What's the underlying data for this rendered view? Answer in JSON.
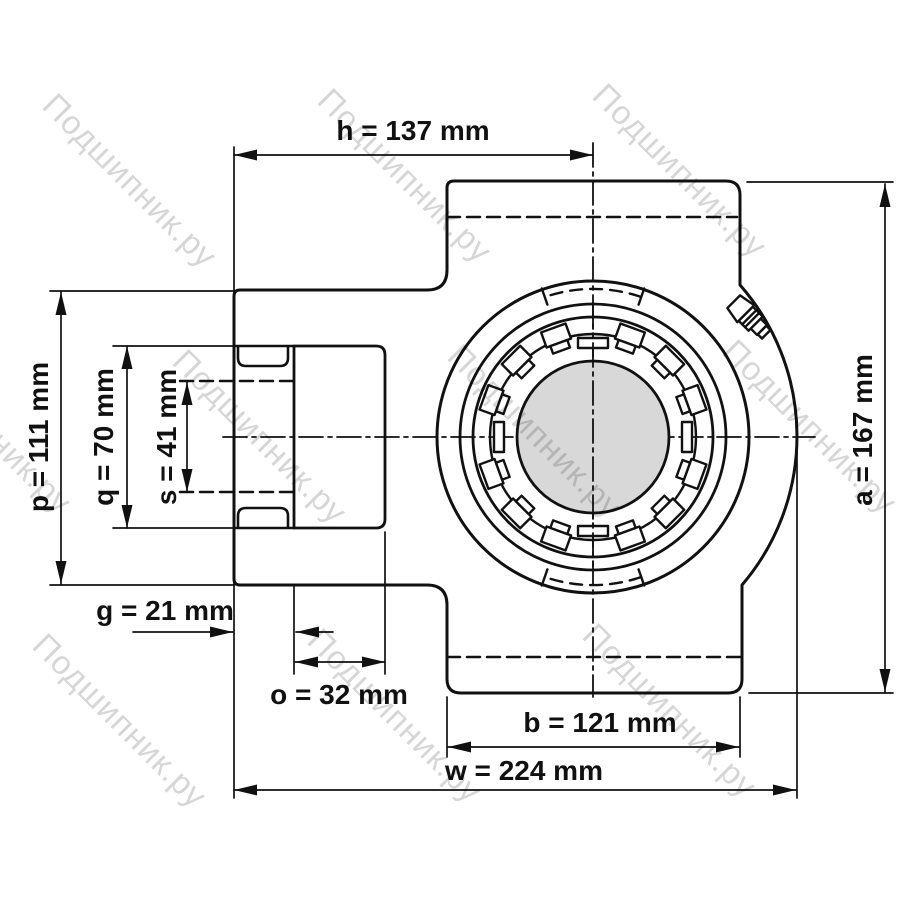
{
  "title": "Take-up bearing unit technical drawing, front view",
  "watermark": {
    "text": "Подшипник.ру",
    "color": "rgba(0,0,0,0.16)"
  },
  "units": "mm",
  "colors": {
    "line": "#111111",
    "bore_fill": "#d8d8d8",
    "background": "#ffffff"
  },
  "dims": {
    "h": {
      "label": "h = 137 mm",
      "value": 137,
      "unit": "mm"
    },
    "p": {
      "label": "p = 111 mm",
      "value": 111,
      "unit": "mm"
    },
    "q": {
      "label": "q = 70 mm",
      "value": 70,
      "unit": "mm"
    },
    "s": {
      "label": "s = 41 mm",
      "value": 41,
      "unit": "mm"
    },
    "g": {
      "label": "g = 21 mm",
      "value": 21,
      "unit": "mm"
    },
    "o": {
      "label": "o = 32 mm",
      "value": 32,
      "unit": "mm"
    },
    "b": {
      "label": "b = 121 mm",
      "value": 121,
      "unit": "mm"
    },
    "w": {
      "label": "w = 224 mm",
      "value": 224,
      "unit": "mm"
    },
    "a": {
      "label": "a = 167 mm",
      "value": 167,
      "unit": "mm"
    }
  }
}
